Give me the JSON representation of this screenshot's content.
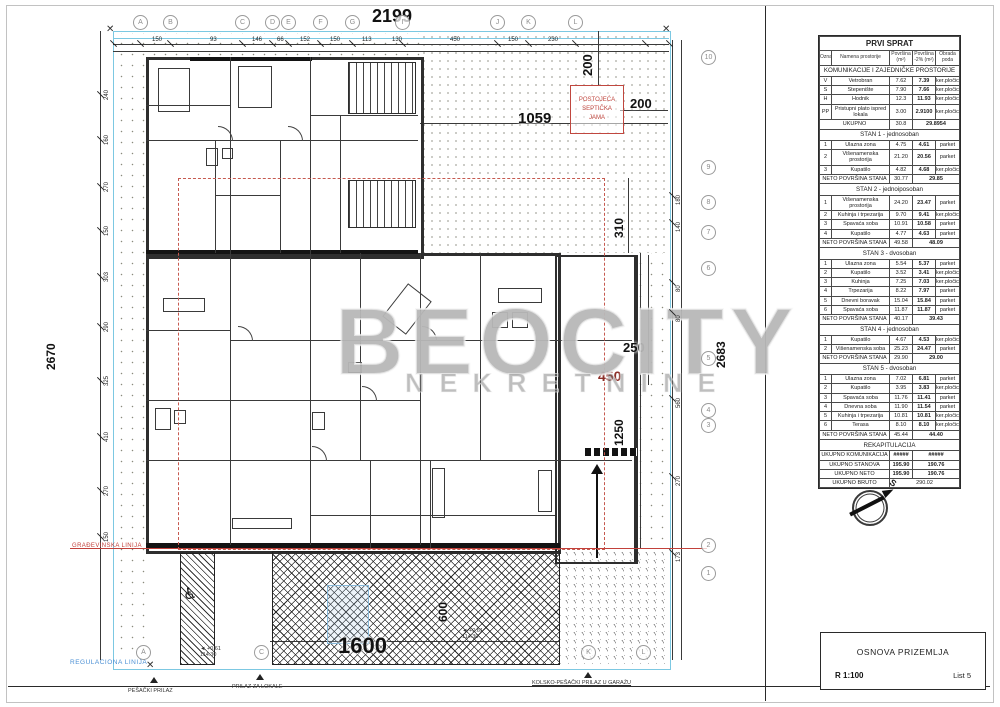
{
  "drawing": {
    "watermark": {
      "line1": "BEOCITY",
      "line2": "NEKRETNINE"
    },
    "labels": {
      "regulation_line": "REGULACIONA LINIJA",
      "building_line": "GRAĐEVINSKA LINIJA",
      "septic_l1": "POSTOJEĆA",
      "septic_l2": "SEPTIČKA",
      "septic_l3": "JAMA",
      "pedestrian_access": "PEŠAČKI PRILAZ",
      "locals_access": "PRILAZ ZA LOKALE",
      "garage_access": "KOLSKO-PEŠAČKI PRILAZ U GARAŽU",
      "north": "S",
      "elev_height": "+0.61",
      "elev_abs": "114.30"
    },
    "big_dims": {
      "top": "2199",
      "bottom": "1600",
      "left": "2670",
      "right": "2683",
      "plot": "1059",
      "septic_h": "200",
      "septic_v": "200",
      "d310": "310",
      "d250": "250",
      "d450": "450",
      "d1250": "1250",
      "d600": "600"
    },
    "top_dims": [
      "150",
      "93",
      "146",
      "66",
      "152",
      "150",
      "113",
      "130",
      "450",
      "150",
      "230"
    ],
    "left_dims": [
      "240",
      "160",
      "270",
      "150",
      "303",
      "290",
      "325",
      "410",
      "270",
      "150"
    ],
    "right_dims": [
      "180",
      "140",
      "80",
      "80",
      "560",
      "270",
      "173"
    ],
    "grid_top": [
      "A",
      "B",
      "C",
      "D",
      "E",
      "F",
      "G",
      "I",
      "J",
      "K",
      "L"
    ],
    "grid_right": [
      "10",
      "9",
      "8",
      "7",
      "6",
      "5",
      "4",
      "3",
      "2",
      "1"
    ],
    "grid_bottom": [
      "A",
      "C",
      "K",
      "L"
    ]
  },
  "table": {
    "title": "PRVI SPRAT",
    "headers": [
      "Oznaka",
      "Namena prostorije",
      "Površina (m²)",
      "Površina -2% (m²)",
      "Obrada poda"
    ],
    "sections": [
      {
        "name": "KOMUNIKACIJE I ZAJEDNIČKE PROSTORIJE",
        "rows": [
          [
            "V",
            "Vetrobran",
            "7.62",
            "7.39",
            "ker.pločice"
          ],
          [
            "S",
            "Stepenište",
            "7.90",
            "7.66",
            "ker.pločice"
          ],
          [
            "H",
            "Hodnik",
            "12.3",
            "11.93",
            "ker.pločice"
          ],
          [
            "PP",
            "Pristupni plato ispred lokala",
            "3.00",
            "2.9100",
            "ker.pločice"
          ]
        ],
        "total": {
          "label": "UKUPNO",
          "v1": "30.8",
          "v2": "29.8954"
        }
      },
      {
        "name": "STAN 1 - jednosoban",
        "rows": [
          [
            "1",
            "Ulazna zona",
            "4.75",
            "4.61",
            "parket"
          ],
          [
            "2",
            "Višenamenska prostorija",
            "21.20",
            "20.56",
            "parket"
          ],
          [
            "3",
            "Kupatilo",
            "4.82",
            "4.68",
            "ker.pločice"
          ]
        ],
        "total": {
          "label": "NETO POVRŠINA STANA",
          "v1": "30.77",
          "v2": "29.85"
        }
      },
      {
        "name": "STAN 2 - jednoiposoban",
        "rows": [
          [
            "1",
            "Višenamenska prostorija",
            "24.20",
            "23.47",
            "parket"
          ],
          [
            "2",
            "Kuhinja i trpezarija",
            "9.70",
            "9.41",
            "ker.pločice"
          ],
          [
            "3",
            "Spavaća soba",
            "10.91",
            "10.58",
            "parket"
          ],
          [
            "4",
            "Kupatilo",
            "4.77",
            "4.63",
            "parket"
          ]
        ],
        "total": {
          "label": "NETO POVRŠINA STANA",
          "v1": "49.58",
          "v2": "48.09"
        }
      },
      {
        "name": "STAN 3 - dvosoban",
        "rows": [
          [
            "1",
            "Ulazna zona",
            "5.54",
            "5.37",
            "parket"
          ],
          [
            "2",
            "Kupatilo",
            "3.52",
            "3.41",
            "ker.pločice"
          ],
          [
            "3",
            "Kuhinja",
            "7.25",
            "7.03",
            "ker.pločice"
          ],
          [
            "4",
            "Trpezarija",
            "8.22",
            "7.97",
            "parket"
          ],
          [
            "5",
            "Dnevni boravak",
            "15.04",
            "15.84",
            "parket"
          ],
          [
            "6",
            "Spavaća soba",
            "11.87",
            "11.87",
            "parket"
          ]
        ],
        "total": {
          "label": "NETO POVRŠINA STANA",
          "v1": "40.17",
          "v2": "39.43"
        }
      },
      {
        "name": "STAN 4 - jednosoban",
        "rows": [
          [
            "1",
            "Kupatilo",
            "4.67",
            "4.53",
            "ker.pločice"
          ],
          [
            "2",
            "Višenamenska soba",
            "25.23",
            "24.47",
            "parket"
          ]
        ],
        "total": {
          "label": "NETO POVRŠINA STANA",
          "v1": "29.90",
          "v2": "29.00"
        }
      },
      {
        "name": "STAN 5 - dvosoban",
        "rows": [
          [
            "1",
            "Ulazna zona",
            "7.02",
            "6.81",
            "parket"
          ],
          [
            "2",
            "Kupatilo",
            "3.95",
            "3.83",
            "ker.pločice"
          ],
          [
            "3",
            "Spavaća soba",
            "11.76",
            "11.41",
            "parket"
          ],
          [
            "4",
            "Dnevna soba",
            "11.90",
            "11.54",
            "parket"
          ],
          [
            "5",
            "Kuhinja i trpezarija",
            "10.81",
            "10.81",
            "ker.pločice"
          ],
          [
            "6",
            "Terasa",
            "8.10",
            "8.10",
            "ker.pločice"
          ]
        ],
        "total": {
          "label": "NETO POVRŠINA STANA",
          "v1": "45.44",
          "v2": "44.40"
        }
      }
    ],
    "recap": {
      "name": "REKAPITULACIJA",
      "rows": [
        [
          "UKUPNO KOMUNIKACIJA",
          "#####",
          "#####"
        ],
        [
          "UKUPNO STANOVA",
          "195.90",
          "190.76"
        ],
        [
          "UKUPNO NETO",
          "195.90",
          "190.76"
        ]
      ],
      "bruto": {
        "label": "UKUPNO BRUTO",
        "value": "290.02"
      }
    }
  },
  "title_block": {
    "title": "OSNOVA PRIZEMLJA",
    "scale": "R 1:100",
    "sheet": "List 5"
  }
}
